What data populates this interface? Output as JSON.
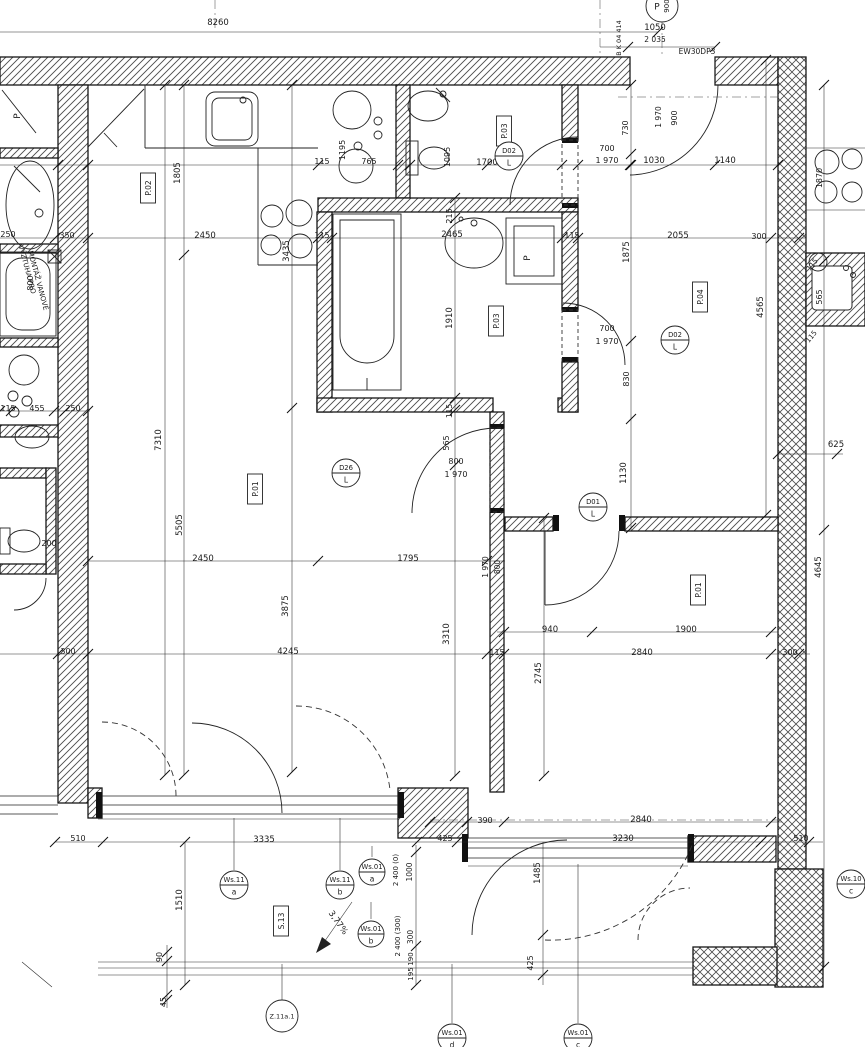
{
  "colors": {
    "ink": "#161616",
    "paper": "#ffffff",
    "hatch": "#4a4a4a"
  },
  "dims": [
    {
      "t": "8260",
      "x": 218,
      "y": 25
    },
    {
      "t": "1050",
      "x": 655,
      "y": 30
    },
    {
      "t": "2 035",
      "x": 655,
      "y": 42,
      "f": 7.5
    },
    {
      "t": "EW30DP3",
      "x": 697,
      "y": 54,
      "f": 7.5
    },
    {
      "t": "B K 04 414",
      "x": 621,
      "y": 38,
      "r": -90,
      "f": 6.5
    },
    {
      "t": "765",
      "x": 369,
      "y": 164,
      "f": 8
    },
    {
      "t": "115",
      "x": 322,
      "y": 164,
      "f": 8
    },
    {
      "t": "1195",
      "x": 345,
      "y": 150,
      "r": -90,
      "f": 8
    },
    {
      "t": "1805",
      "x": 180,
      "y": 173,
      "r": -90
    },
    {
      "t": "1700",
      "x": 487,
      "y": 165
    },
    {
      "t": "1095",
      "x": 450,
      "y": 157,
      "r": -90,
      "f": 8
    },
    {
      "t": "700",
      "x": 607,
      "y": 151,
      "f": 8
    },
    {
      "t": "1 970",
      "x": 607,
      "y": 163,
      "f": 8
    },
    {
      "t": "1030",
      "x": 654,
      "y": 163
    },
    {
      "t": "1140",
      "x": 725,
      "y": 163
    },
    {
      "t": "730",
      "x": 628,
      "y": 128,
      "r": -90,
      "f": 8
    },
    {
      "t": "1 970",
      "x": 661,
      "y": 117,
      "r": -90,
      "f": 7.5
    },
    {
      "t": "900",
      "x": 677,
      "y": 118,
      "r": -90,
      "f": 8
    },
    {
      "t": "350",
      "x": 67,
      "y": 238,
      "f": 8
    },
    {
      "t": "2450",
      "x": 205,
      "y": 238
    },
    {
      "t": "3435",
      "x": 289,
      "y": 251,
      "r": -90
    },
    {
      "t": "115",
      "x": 322,
      "y": 238,
      "f": 8
    },
    {
      "t": "2465",
      "x": 452,
      "y": 237
    },
    {
      "t": "215",
      "x": 452,
      "y": 216,
      "r": -90,
      "f": 8
    },
    {
      "t": "115",
      "x": 572,
      "y": 238,
      "f": 8
    },
    {
      "t": "2055",
      "x": 678,
      "y": 238
    },
    {
      "t": "300",
      "x": 759,
      "y": 239,
      "f": 8
    },
    {
      "t": "1875",
      "x": 629,
      "y": 252,
      "r": -90
    },
    {
      "t": "250",
      "x": 8,
      "y": 237,
      "f": 8
    },
    {
      "t": "800",
      "x": 33,
      "y": 283,
      "r": -90,
      "f": 8
    },
    {
      "t": "1910",
      "x": 452,
      "y": 318,
      "r": -90
    },
    {
      "t": "830",
      "x": 629,
      "y": 379,
      "r": -90,
      "f": 8
    },
    {
      "t": "700",
      "x": 607,
      "y": 331,
      "f": 8
    },
    {
      "t": "1 970",
      "x": 607,
      "y": 344,
      "f": 8
    },
    {
      "t": "4565",
      "x": 763,
      "y": 307,
      "r": -90
    },
    {
      "t": "1870",
      "x": 822,
      "y": 178,
      "r": -90,
      "f": 8
    },
    {
      "t": "115",
      "x": 814,
      "y": 266,
      "r": -50,
      "f": 7
    },
    {
      "t": "565",
      "x": 822,
      "y": 297,
      "r": -90,
      "f": 8
    },
    {
      "t": "115",
      "x": 813,
      "y": 338,
      "r": -50,
      "f": 7
    },
    {
      "t": "115",
      "x": 8,
      "y": 411,
      "f": 8
    },
    {
      "t": "455",
      "x": 37,
      "y": 411,
      "f": 8
    },
    {
      "t": "250",
      "x": 73,
      "y": 411,
      "f": 8
    },
    {
      "t": "200",
      "x": 49,
      "y": 546,
      "f": 8
    },
    {
      "t": "7310",
      "x": 161,
      "y": 440,
      "r": -90
    },
    {
      "t": "5505",
      "x": 182,
      "y": 525,
      "r": -90
    },
    {
      "t": "2450",
      "x": 203,
      "y": 561
    },
    {
      "t": "1795",
      "x": 408,
      "y": 561
    },
    {
      "t": "800",
      "x": 456,
      "y": 464,
      "f": 8
    },
    {
      "t": "1 970",
      "x": 456,
      "y": 477,
      "f": 8
    },
    {
      "t": "565",
      "x": 449,
      "y": 443,
      "r": -90,
      "f": 8
    },
    {
      "t": "115",
      "x": 452,
      "y": 411,
      "r": -90,
      "f": 7.5
    },
    {
      "t": "D26",
      "x": 0,
      "y": -9999
    },
    {
      "t": "1130",
      "x": 626,
      "y": 473,
      "r": -90
    },
    {
      "t": "800",
      "x": 500,
      "y": 567,
      "r": -90,
      "f": 7.5
    },
    {
      "t": "1 970",
      "x": 488,
      "y": 567,
      "r": -90,
      "f": 7.5
    },
    {
      "t": "940",
      "x": 550,
      "y": 632
    },
    {
      "t": "1900",
      "x": 686,
      "y": 632
    },
    {
      "t": "2840",
      "x": 642,
      "y": 655
    },
    {
      "t": "115",
      "x": 497,
      "y": 655,
      "f": 8
    },
    {
      "t": "300",
      "x": 790,
      "y": 655,
      "f": 8
    },
    {
      "t": "300",
      "x": 68,
      "y": 654,
      "f": 8
    },
    {
      "t": "4245",
      "x": 288,
      "y": 654
    },
    {
      "t": "3875",
      "x": 288,
      "y": 606,
      "r": -90
    },
    {
      "t": "3310",
      "x": 449,
      "y": 634,
      "r": -90
    },
    {
      "t": "2745",
      "x": 541,
      "y": 673,
      "r": -90
    },
    {
      "t": "625",
      "x": 836,
      "y": 447
    },
    {
      "t": "4645",
      "x": 821,
      "y": 567,
      "r": -90
    },
    {
      "t": "390",
      "x": 485,
      "y": 823,
      "f": 8
    },
    {
      "t": "2840",
      "x": 641,
      "y": 822
    },
    {
      "t": "425",
      "x": 445,
      "y": 841,
      "f": 8
    },
    {
      "t": "3230",
      "x": 623,
      "y": 841
    },
    {
      "t": "510",
      "x": 801,
      "y": 841,
      "f": 8
    },
    {
      "t": "510",
      "x": 78,
      "y": 841,
      "f": 8
    },
    {
      "t": "3335",
      "x": 264,
      "y": 842
    },
    {
      "t": "1510",
      "x": 182,
      "y": 900,
      "r": -90
    },
    {
      "t": "90",
      "x": 162,
      "y": 957,
      "r": -90,
      "f": 8
    },
    {
      "t": "45",
      "x": 166,
      "y": 1002,
      "r": -90,
      "f": 8
    },
    {
      "t": "1485",
      "x": 540,
      "y": 873,
      "r": -90
    },
    {
      "t": "425",
      "x": 533,
      "y": 963,
      "r": -90,
      "f": 8
    },
    {
      "t": "1000",
      "x": 412,
      "y": 872,
      "r": -90,
      "f": 7.5
    },
    {
      "t": "2 400 (0)",
      "x": 398,
      "y": 870,
      "r": -90,
      "f": 7
    },
    {
      "t": "2 400 (300)",
      "x": 400,
      "y": 936,
      "r": -90,
      "f": 7
    },
    {
      "t": "300",
      "x": 413,
      "y": 937,
      "r": -90,
      "f": 7.5
    },
    {
      "t": "190",
      "x": 413,
      "y": 959,
      "r": -90,
      "f": 7
    },
    {
      "t": "195",
      "x": 413,
      "y": 974,
      "r": -90,
      "f": 7
    },
    {
      "t": "3,77%",
      "x": 336,
      "y": 924,
      "r": 55
    },
    {
      "t": "VÝZTUHA PRO",
      "x": 25,
      "y": 270,
      "r": 75,
      "f": 7
    },
    {
      "t": "MONTÁŽ VANOVÉ",
      "x": 36,
      "y": 281,
      "r": 75,
      "f": 7
    },
    {
      "t": "P",
      "x": 20,
      "y": 116,
      "r": -90,
      "f": 9
    },
    {
      "t": "P",
      "x": 530,
      "y": 258,
      "r": -90,
      "f": 9
    }
  ],
  "rooms": [
    {
      "label": "P.02",
      "x": 148,
      "y": 188
    },
    {
      "label": "P.01",
      "x": 255,
      "y": 489
    },
    {
      "label": "P.03",
      "x": 504,
      "y": 131
    },
    {
      "label": "P.03",
      "x": 496,
      "y": 321
    },
    {
      "label": "P.04",
      "x": 700,
      "y": 297
    },
    {
      "label": "P.01",
      "x": 698,
      "y": 590
    },
    {
      "label": "S.13",
      "x": 281,
      "y": 921
    }
  ],
  "markers": [
    {
      "id": "D02",
      "sub": "L",
      "x": 509,
      "y": 156
    },
    {
      "id": "D02",
      "sub": "L",
      "x": 675,
      "y": 340
    },
    {
      "id": "D26",
      "sub": "L",
      "x": 346,
      "y": 473
    },
    {
      "id": "D01",
      "sub": "L",
      "x": 593,
      "y": 507
    },
    {
      "id": "Ws.11",
      "sub": "a",
      "x": 234,
      "y": 885
    },
    {
      "id": "Ws.11",
      "sub": "b",
      "x": 340,
      "y": 885
    },
    {
      "id": "Ws.01",
      "sub": "a",
      "x": 372,
      "y": 872,
      "rad": 13
    },
    {
      "id": "Ws.01",
      "sub": "b",
      "x": 371,
      "y": 934,
      "rad": 13
    },
    {
      "id": "Ws.01",
      "sub": "d",
      "x": 452,
      "y": 1038
    },
    {
      "id": "Ws.01",
      "sub": "c",
      "x": 578,
      "y": 1038
    },
    {
      "id": "Ws.10",
      "sub": "c",
      "x": 851,
      "y": 884
    },
    {
      "id": "Z.11a.1",
      "sub": "",
      "x": 282,
      "y": 1016,
      "rad": 16,
      "f": 6.5
    },
    {
      "id": "P",
      "sub": "900",
      "x": 662,
      "y": 6,
      "side": true,
      "rad": 16
    }
  ]
}
